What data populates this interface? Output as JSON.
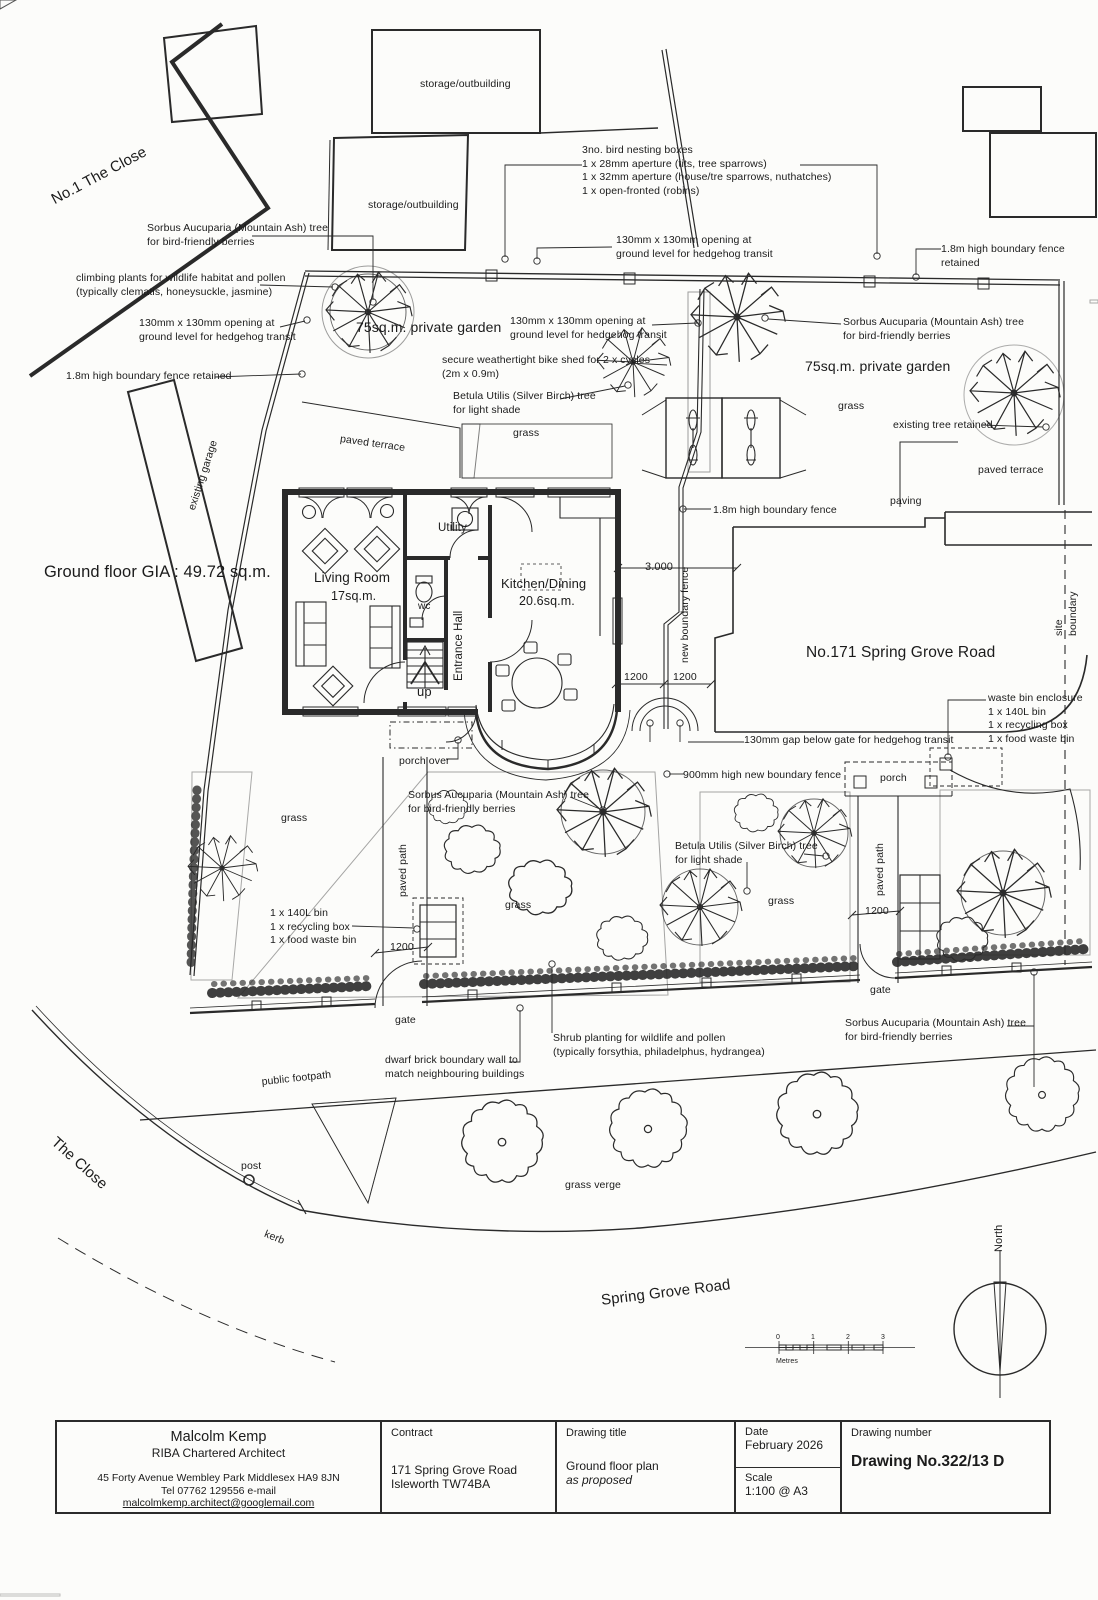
{
  "annotations": [
    {
      "name": "label-no1-the-close",
      "text": "No.1 The Close",
      "x": 48,
      "y": 192,
      "size": 15,
      "rot": -28
    },
    {
      "name": "label-storage-outbuilding-top",
      "text": "storage/outbuilding",
      "x": 420,
      "y": 78,
      "size": 10.5
    },
    {
      "name": "label-storage-outbuilding-2",
      "text": "storage/outbuilding",
      "x": 368,
      "y": 199,
      "size": 10.5
    },
    {
      "name": "label-bird-nesting-boxes",
      "text": "3no. bird nesting boxes\n1 x 28mm aperture (tits, tree sparrows)\n1 x 32mm aperture (house/tre sparrows, nuthatches)\n1 x open-fronted (robins)",
      "x": 582,
      "y": 144,
      "size": 10.5
    },
    {
      "name": "label-sorbus-top-left",
      "text": "Sorbus Aucuparia (Mountain Ash) tree\nfor bird-friendly berries",
      "x": 147,
      "y": 222,
      "size": 10.5
    },
    {
      "name": "label-climbing-plants",
      "text": "climbing plants for wildlife habitat and pollen\n(typically clematis, honeysuckle, jasmine)",
      "x": 76,
      "y": 272,
      "size": 10.5
    },
    {
      "name": "label-hedgehog-opening-left",
      "text": "130mm x 130mm opening at\nground level for hedgehog transit",
      "x": 139,
      "y": 317,
      "size": 10.5
    },
    {
      "name": "label-fence-retained-left",
      "text": "1.8m high boundary fence retained",
      "x": 66,
      "y": 370,
      "size": 10.5
    },
    {
      "name": "label-hedgehog-opening-top",
      "text": "130mm x 130mm opening at\nground level for hedgehog transit",
      "x": 616,
      "y": 234,
      "size": 10.5
    },
    {
      "name": "label-fence-retained-right",
      "text": "1.8m high boundary fence retained",
      "x": 941,
      "y": 243,
      "size": 10.5
    },
    {
      "name": "label-private-garden-left",
      "text": "75sq.m. private garden",
      "x": 356,
      "y": 318,
      "size": 14
    },
    {
      "name": "label-private-garden-right",
      "text": "75sq.m. private garden",
      "x": 805,
      "y": 357,
      "size": 14
    },
    {
      "name": "label-sorbus-right-garden",
      "text": "Sorbus Aucuparia (Mountain Ash) tree\nfor bird-friendly berries",
      "x": 843,
      "y": 316,
      "size": 10.5
    },
    {
      "name": "label-hedgehog-opening-mid",
      "text": "130mm x 130mm opening at\nground level for hedgehog transit",
      "x": 510,
      "y": 315,
      "size": 10.5
    },
    {
      "name": "label-bike-shed",
      "text": "secure weathertight bike shed for 2 x cycles\n(2m x 0.9m)",
      "x": 442,
      "y": 354,
      "size": 10.5
    },
    {
      "name": "label-betula-left",
      "text": "Betula Utilis (Silver Birch) tree\nfor light shade",
      "x": 453,
      "y": 390,
      "size": 10.5
    },
    {
      "name": "label-grass-left-garden",
      "text": "grass",
      "x": 513,
      "y": 427,
      "size": 10.5
    },
    {
      "name": "label-grass-right-garden",
      "text": "grass",
      "x": 838,
      "y": 400,
      "size": 10.5
    },
    {
      "name": "label-existing-tree-retained",
      "text": "existing tree retained",
      "x": 893,
      "y": 419,
      "size": 10.5
    },
    {
      "name": "label-paved-terrace-right",
      "text": "paved terrace",
      "x": 978,
      "y": 464,
      "size": 10.5
    },
    {
      "name": "label-paving",
      "text": "paving",
      "x": 890,
      "y": 495,
      "size": 10.5
    },
    {
      "name": "label-paved-terrace-left",
      "text": "paved terrace",
      "x": 341,
      "y": 433,
      "size": 10.5,
      "rot": 8
    },
    {
      "name": "label-existing-garage",
      "text": "existing garage",
      "x": 186,
      "y": 508,
      "size": 10.5,
      "rot": -72
    },
    {
      "name": "label-ground-floor-gia",
      "text": "Ground floor GIA : 49.72 sq.m.",
      "x": 44,
      "y": 562,
      "size": 16.5
    },
    {
      "name": "label-living-room",
      "text": "Living Room",
      "x": 314,
      "y": 569,
      "size": 13.5
    },
    {
      "name": "label-living-room-area",
      "text": "17sq.m.",
      "x": 331,
      "y": 588,
      "size": 12.5
    },
    {
      "name": "label-utility",
      "text": "Utility",
      "x": 438,
      "y": 521,
      "size": 11.5
    },
    {
      "name": "label-wc",
      "text": "wc",
      "x": 418,
      "y": 600,
      "size": 10
    },
    {
      "name": "label-entrance-hall",
      "text": "Entrance Hall",
      "x": 452,
      "y": 681,
      "size": 11.5,
      "rot": -90
    },
    {
      "name": "label-up",
      "text": "up",
      "x": 417,
      "y": 684,
      "size": 13
    },
    {
      "name": "label-kitchen-dining",
      "text": "Kitchen/Dining",
      "x": 501,
      "y": 576,
      "size": 13
    },
    {
      "name": "label-kitchen-area",
      "text": "20.6sq.m.",
      "x": 519,
      "y": 593,
      "size": 12.5
    },
    {
      "name": "label-fence-18-mid",
      "text": "1.8m high boundary fence",
      "x": 713,
      "y": 504,
      "size": 10.5
    },
    {
      "name": "label-dim-3000",
      "text": "3.000",
      "x": 645,
      "y": 560,
      "size": 11
    },
    {
      "name": "label-new-boundary-fence",
      "text": "new boundary fence",
      "x": 679,
      "y": 663,
      "size": 10.5,
      "rot": -90
    },
    {
      "name": "label-no171",
      "text": "No.171 Spring Grove Road",
      "x": 806,
      "y": 643,
      "size": 15.5
    },
    {
      "name": "label-site-boundary",
      "text": "site boundary",
      "x": 1053,
      "y": 636,
      "size": 10.5,
      "rot": -90
    },
    {
      "name": "label-dim-1200-a",
      "text": "1200",
      "x": 624,
      "y": 671,
      "size": 10.5
    },
    {
      "name": "label-dim-1200-b",
      "text": "1200",
      "x": 673,
      "y": 671,
      "size": 10.5
    },
    {
      "name": "label-hedgehog-gap-gate",
      "text": "130mm gap below gate for hedgehog transit",
      "x": 744,
      "y": 734,
      "size": 10.5
    },
    {
      "name": "label-waste-bin-enclosure",
      "text": "waste bin enclosure\n1 x 140L bin\n1 x recycling box\n1 x food waste bin",
      "x": 988,
      "y": 692,
      "size": 10.5
    },
    {
      "name": "label-porch-over",
      "text": "porch over",
      "x": 399,
      "y": 755,
      "size": 10.5
    },
    {
      "name": "label-sorbus-front",
      "text": "Sorbus Aucuparia (Mountain Ash) tree\nfor bird-friendly berries",
      "x": 408,
      "y": 789,
      "size": 10.5
    },
    {
      "name": "label-fence-900",
      "text": "900mm high new boundary fence",
      "x": 683,
      "y": 769,
      "size": 10.5
    },
    {
      "name": "label-porch-right",
      "text": "porch",
      "x": 880,
      "y": 772,
      "size": 10.5
    },
    {
      "name": "label-betula-front",
      "text": "Betula Utilis (Silver Birch) tree\nfor light shade",
      "x": 675,
      "y": 840,
      "size": 10.5
    },
    {
      "name": "label-grass-front-left",
      "text": "grass",
      "x": 281,
      "y": 812,
      "size": 10.5
    },
    {
      "name": "label-grass-front-mid",
      "text": "grass",
      "x": 505,
      "y": 899,
      "size": 10.5
    },
    {
      "name": "label-grass-front-right",
      "text": "grass",
      "x": 768,
      "y": 895,
      "size": 10.5
    },
    {
      "name": "label-paved-path-left",
      "text": "paved path",
      "x": 397,
      "y": 897,
      "size": 10.5,
      "rot": -90
    },
    {
      "name": "label-paved-path-right",
      "text": "paved path",
      "x": 874,
      "y": 896,
      "size": 10.5,
      "rot": -90
    },
    {
      "name": "label-bins-left",
      "text": "1 x 140L bin\n1 x recycling box\n1 x food waste bin",
      "x": 270,
      "y": 907,
      "size": 10.5
    },
    {
      "name": "label-dim-1200-c",
      "text": "1200",
      "x": 390,
      "y": 941,
      "size": 10.5
    },
    {
      "name": "label-dim-1200-d",
      "text": "1200",
      "x": 865,
      "y": 905,
      "size": 10.5
    },
    {
      "name": "label-gate-left",
      "text": "gate",
      "x": 395,
      "y": 1014,
      "size": 10.5
    },
    {
      "name": "label-gate-right",
      "text": "gate",
      "x": 870,
      "y": 984,
      "size": 10.5
    },
    {
      "name": "label-shrub-planting",
      "text": "Shrub planting for wildlife and pollen\n(typically forsythia, philadelphus, hydrangea)",
      "x": 553,
      "y": 1032,
      "size": 10.5
    },
    {
      "name": "label-dwarf-wall",
      "text": "dwarf brick boundary wall to\nmatch neighbouring buildings",
      "x": 385,
      "y": 1054,
      "size": 10.5
    },
    {
      "name": "label-public-footpath",
      "text": "public footpath",
      "x": 261,
      "y": 1076,
      "size": 10.5,
      "rot": -6
    },
    {
      "name": "label-sorbus-bottom",
      "text": "Sorbus Aucuparia (Mountain Ash) tree\nfor bird-friendly berries",
      "x": 845,
      "y": 1017,
      "size": 10.5
    },
    {
      "name": "label-the-close",
      "text": "The Close",
      "x": 60,
      "y": 1133,
      "size": 15,
      "rot": 42
    },
    {
      "name": "label-post",
      "text": "post",
      "x": 241,
      "y": 1160,
      "size": 10.5
    },
    {
      "name": "label-kerb",
      "text": "kerb",
      "x": 267,
      "y": 1228,
      "size": 10.5,
      "rot": 22
    },
    {
      "name": "label-grass-verge",
      "text": "grass verge",
      "x": 565,
      "y": 1179,
      "size": 10.5
    },
    {
      "name": "label-spring-grove-road",
      "text": "Spring Grove Road",
      "x": 600,
      "y": 1291,
      "size": 15,
      "rot": -7
    },
    {
      "name": "label-scale-0",
      "text": "0",
      "x": 776,
      "y": 1333,
      "size": 7
    },
    {
      "name": "label-scale-1",
      "text": "1",
      "x": 811,
      "y": 1333,
      "size": 7
    },
    {
      "name": "label-scale-2",
      "text": "2",
      "x": 846,
      "y": 1333,
      "size": 7
    },
    {
      "name": "label-scale-3",
      "text": "3",
      "x": 881,
      "y": 1333,
      "size": 7
    },
    {
      "name": "label-scale-metres",
      "text": "Metres",
      "x": 776,
      "y": 1357,
      "size": 7
    },
    {
      "name": "label-north",
      "text": "North",
      "x": 992,
      "y": 1252,
      "size": 11,
      "rot": -90
    }
  ],
  "title_block": {
    "architect": {
      "name": "Malcolm Kemp",
      "role": "RIBA Chartered Architect",
      "address": "45 Forty Avenue Wembley Park Middlesex HA9 8JN",
      "tel": "Tel 07762 129556  e-mail ",
      "email": "malcolmkemp.architect@googlemail.com"
    },
    "contract": {
      "label": "Contract",
      "line1": "171 Spring Grove Road",
      "line2": "Isleworth TW74BA"
    },
    "drawing_title": {
      "label": "Drawing title",
      "line1": "Ground floor plan",
      "line2": "as proposed"
    },
    "date": {
      "label": "Date",
      "value": "February 2026"
    },
    "scale": {
      "label": "Scale",
      "value": "1:100 @ A3"
    },
    "number": {
      "label": "Drawing number",
      "value": "Drawing No.322/13 D"
    }
  },
  "colors": {
    "ink": "#2a2a2a",
    "paper": "#fcfcfa"
  }
}
